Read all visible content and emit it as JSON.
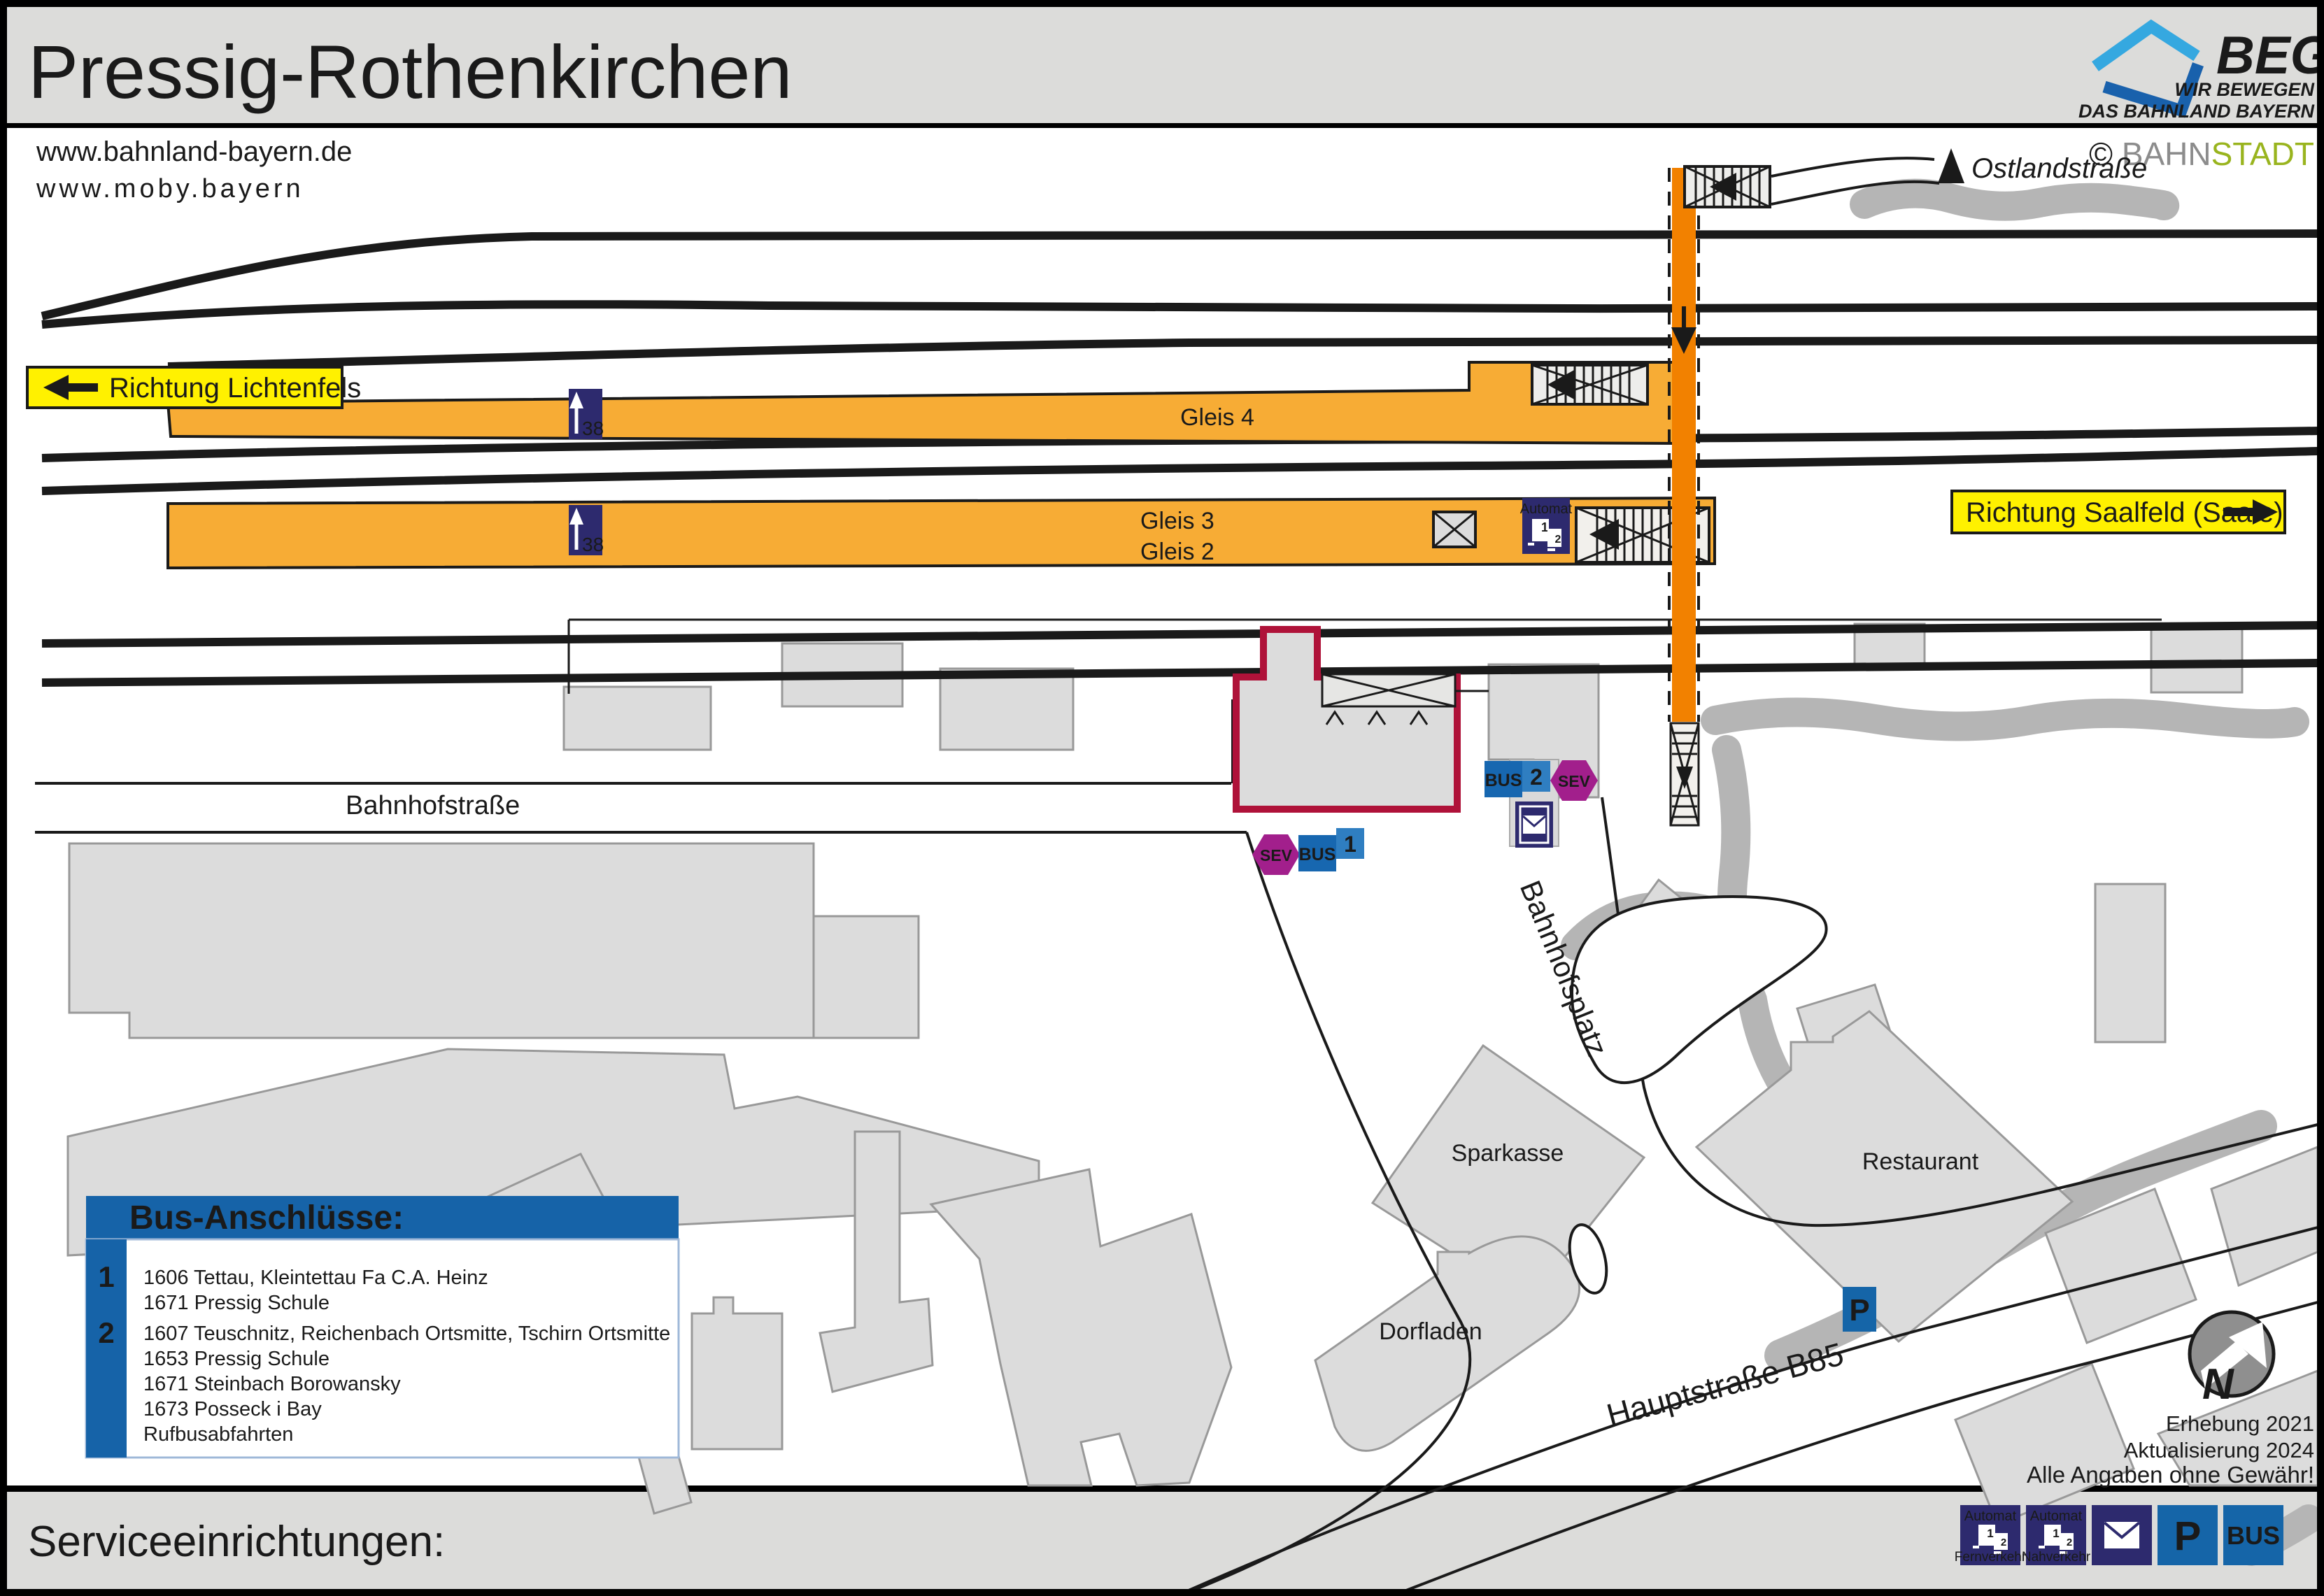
{
  "title": "Pressig-Rothenkirchen",
  "links": {
    "bahnland": "www.bahnland-bayern.de",
    "moby": "www.moby.bayern"
  },
  "beg": {
    "name": "BEG",
    "tag1": "WIR BEWEGEN",
    "tag2": "DAS BAHNLAND BAYERN"
  },
  "bahnstadt": {
    "copy": "© ",
    "part1": "BAHN",
    "part2": "STADT"
  },
  "signs": {
    "lichtenfels": "Richtung Lichtenfels",
    "saalfeld": "Richtung Saalfeld (Saale)"
  },
  "streets": {
    "ostlandstrasse": "Ostlandstraße",
    "bahnhofstrasse": "Bahnhofstraße",
    "bahnhofsplatz": "Bahnhofsplatz",
    "hauptstrasse": "Hauptstraße B85"
  },
  "platforms": {
    "gleis4": "Gleis 4",
    "gleis3": "Gleis 3",
    "gleis2": "Gleis 2",
    "height38": "38"
  },
  "pois": {
    "sparkasse": "Sparkasse",
    "dorfladen": "Dorfladen",
    "restaurant": "Restaurant"
  },
  "stops": {
    "bus": "BUS",
    "sev": "SEV",
    "n1": "1",
    "n2": "2"
  },
  "automat": {
    "label": "Automat",
    "t1": "1",
    "t2": "2"
  },
  "legend": {
    "title": "Bus-Anschlüsse:",
    "g1": {
      "badge": "1",
      "l1": "1606 Tettau, Kleintettau Fa C.A. Heinz",
      "l2": "1671 Pressig Schule"
    },
    "g2": {
      "badge": "2",
      "l1": "1607 Teuschnitz, Reichenbach Ortsmitte, Tschirn Ortsmitte",
      "l2": "1653 Pressig Schule",
      "l3": "1671 Steinbach Borowansky",
      "l4": "1673 Posseck i Bay",
      "l5": "Rufbusabfahrten"
    }
  },
  "footer": {
    "title": "Serviceeinrichtungen:",
    "fern": "Fernverkehr",
    "nah": "Nahverkehr",
    "p": "P",
    "bus": "BUS"
  },
  "meta": {
    "l1": "Erhebung 2021",
    "l2": "Aktualisierung 2024",
    "l3": "Alle Angaben ohne Gewähr!"
  },
  "compass": {
    "n": "N"
  },
  "colors": {
    "platform_orange": "#F7AC35",
    "route_orange": "#F28100",
    "navy": "#2D2A6E",
    "blue": "#1565A8",
    "light_blue": "#2F7EC1",
    "sev_magenta": "#A21F8C",
    "station_crimson": "#AF1239",
    "sign_yellow": "#FFF100",
    "building_gray": "#DCDCDC",
    "vegetation_gray": "#B5B5B5",
    "header_gray": "#DCDCDA"
  }
}
